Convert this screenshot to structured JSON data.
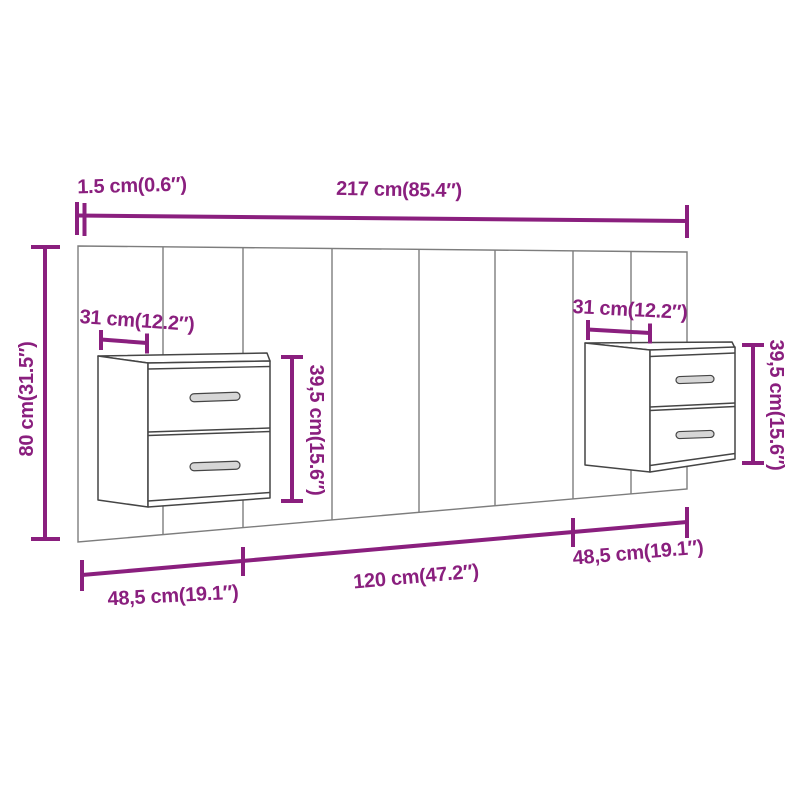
{
  "colors": {
    "dimension": "#8A1F7E",
    "panel_line": "#7D7D7D",
    "cabinet_line": "#454545",
    "background": "#FFFFFF"
  },
  "dimensions": {
    "panel_thickness": "1.5 cm(0.6″)",
    "total_width": "217 cm(85.4″)",
    "total_height": "80 cm(31.5″)",
    "left_cabinet_width": "31 cm(12.2″)",
    "left_cabinet_height": "39,5 cm(15.6″)",
    "right_cabinet_width": "31 cm(12.2″)",
    "right_cabinet_height": "39,5 cm(15.6″)",
    "bottom_left_segment": "48,5 cm(19.1″)",
    "bottom_center_segment": "120 cm(47.2″)",
    "bottom_right_segment": "48,5 cm(19.1″)"
  }
}
